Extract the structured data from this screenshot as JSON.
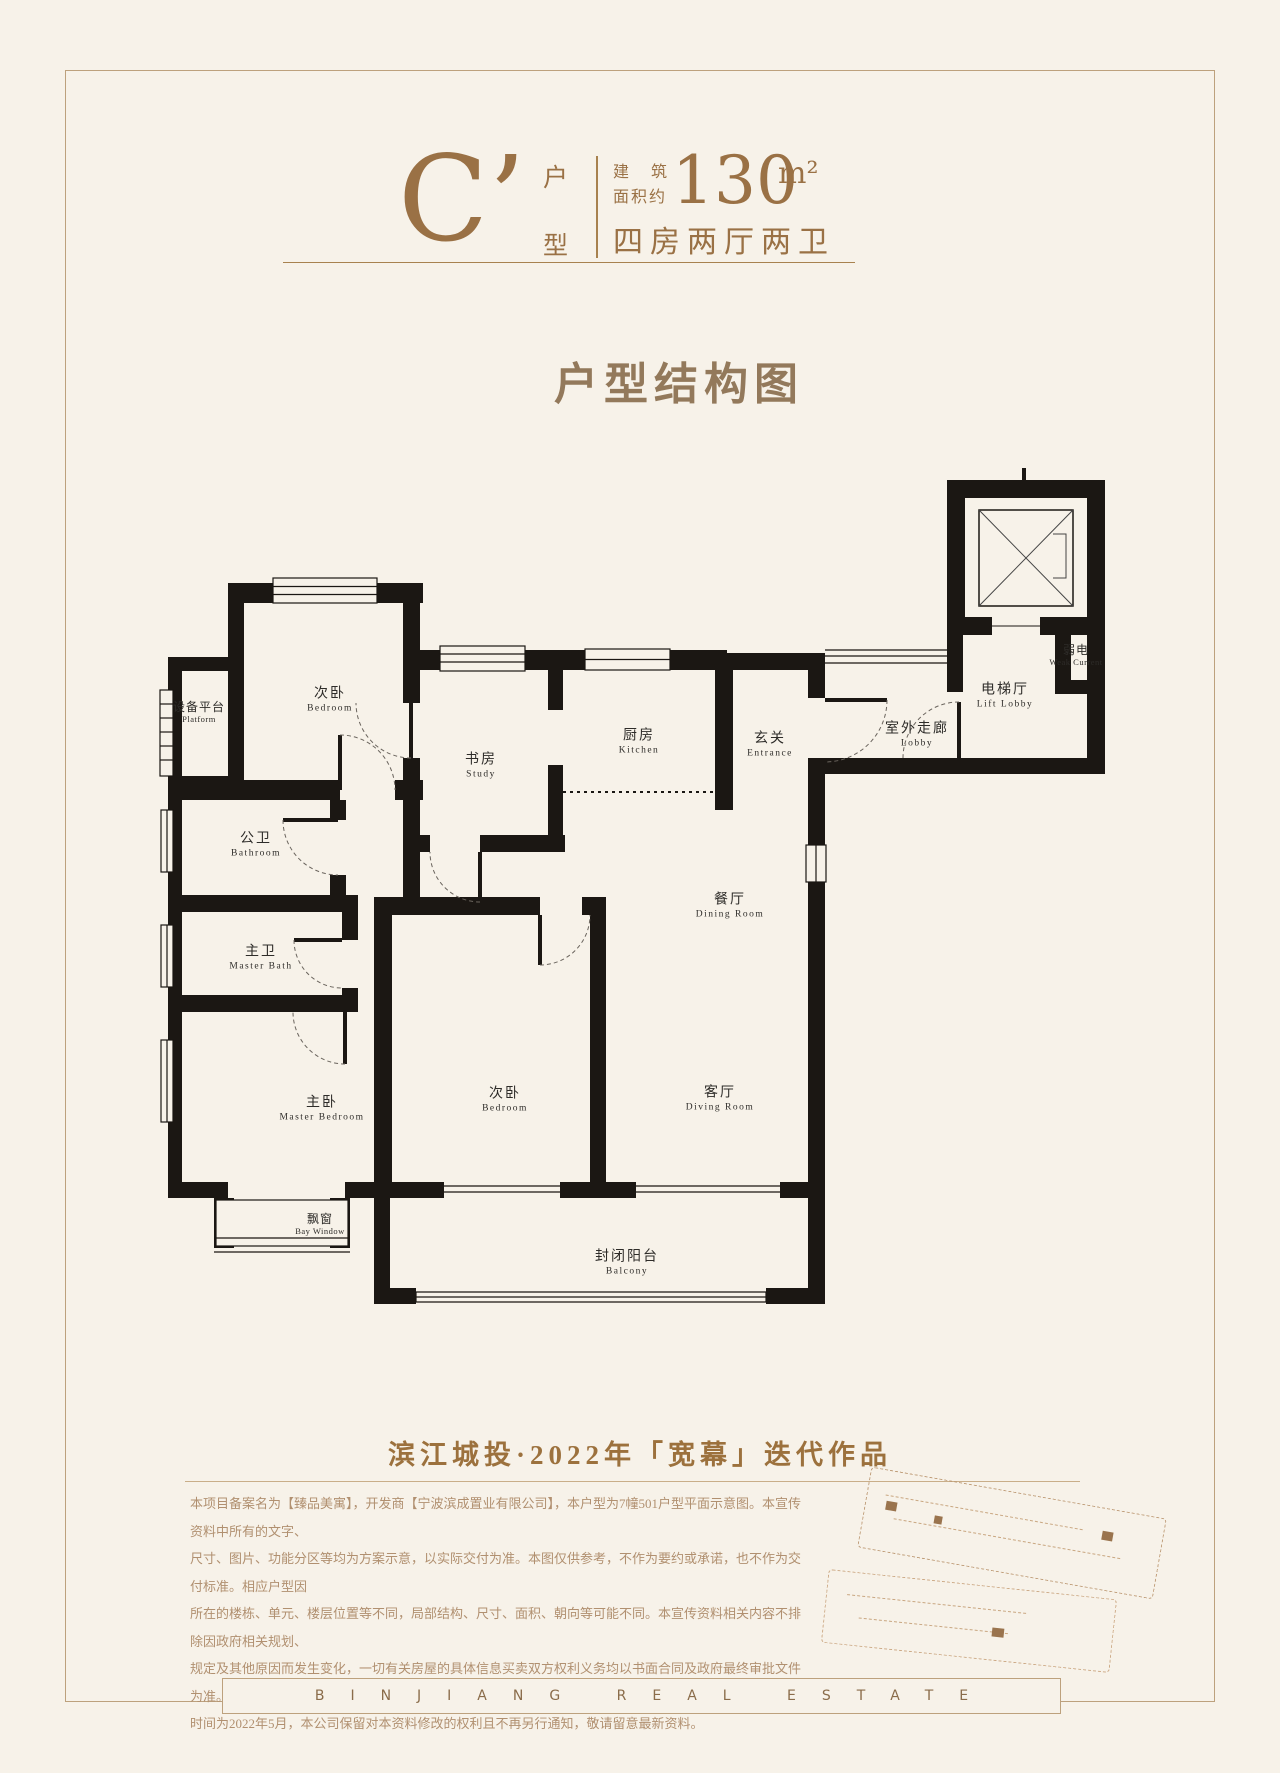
{
  "colors": {
    "background": "#f7f2e9",
    "accent_brown": "#9a7145",
    "wall_black": "#1b1713",
    "frame": "#bda17d"
  },
  "header": {
    "unit_letter": "C’",
    "unit_type_top": "户",
    "unit_type_bottom": "型",
    "area_label_line1": "建 筑",
    "area_label_line2": "面积约",
    "area_value": "130",
    "area_unit": "m²",
    "layout_desc": "四房两厅两卫"
  },
  "title": "户型结构图",
  "floorplan": {
    "rooms": [
      {
        "id": "platform",
        "cn": "设备平台",
        "en": "Platform"
      },
      {
        "id": "bedroom-top",
        "cn": "次卧",
        "en": "Bedroom"
      },
      {
        "id": "study",
        "cn": "书房",
        "en": "Study"
      },
      {
        "id": "kitchen",
        "cn": "厨房",
        "en": "Kitchen"
      },
      {
        "id": "entrance",
        "cn": "玄关",
        "en": "Entrance"
      },
      {
        "id": "outdoor-corridor",
        "cn": "室外走廊",
        "en": "Lobby"
      },
      {
        "id": "lift-lobby",
        "cn": "电梯厅",
        "en": "Lift Lobby"
      },
      {
        "id": "weak-current",
        "cn": "弱电",
        "en": "Weak Current"
      },
      {
        "id": "bathroom",
        "cn": "公卫",
        "en": "Bathroom"
      },
      {
        "id": "master-bath",
        "cn": "主卫",
        "en": "Master Bath"
      },
      {
        "id": "dining-room",
        "cn": "餐厅",
        "en": "Dining Room"
      },
      {
        "id": "master-bedroom",
        "cn": "主卧",
        "en": "Master Bedroom"
      },
      {
        "id": "bedroom-bottom",
        "cn": "次卧",
        "en": "Bedroom"
      },
      {
        "id": "living-room",
        "cn": "客厅",
        "en": "Diving Room"
      },
      {
        "id": "bay-window",
        "cn": "飘窗",
        "en": "Bay Window"
      },
      {
        "id": "balcony",
        "cn": "封闭阳台",
        "en": "Balcony"
      }
    ]
  },
  "tagline": "滨江城投·2022年「宽幕」迭代作品",
  "disclaimer": {
    "lines": [
      "本项目备案名为【臻品美寓】，开发商【宁波滨成置业有限公司】，本户型为7幢501户型平面示意图。本宣传资料中所有的文字、",
      "尺寸、图片、功能分区等均为方案示意，以实际交付为准。本图仅供参考，不作为要约或承诺，也不作为交付标准。相应户型因",
      "所在的楼栋、单元、楼层位置等不同，局部结构、尺寸、面积、朝向等可能不同。本宣传资料相关内容不排除因政府相关规划、",
      "规定及其他原因而发生变化，一切有关房屋的具体信息买卖双方权利义务均以书面合同及政府最终审批文件为准。本资料的发布",
      "时间为2022年5月，本公司保留对本资料修改的权利且不再另行通知，敬请留意最新资料。"
    ]
  },
  "footer": {
    "brand": "BINJIANG REAL ESTATE"
  }
}
